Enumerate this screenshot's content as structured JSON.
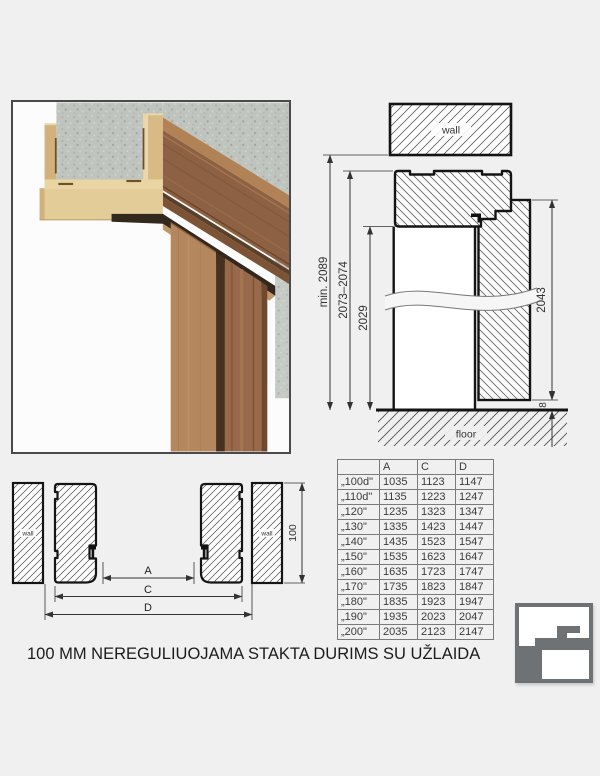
{
  "caption": "100 MM NEREGULIUOJAMA STAKTA DURIMS SU UŽLAIDA",
  "vertical_section": {
    "wall_label": "wall",
    "floor_label": "floor",
    "dims": {
      "min_total_height": "min. 2089",
      "frame_outer_height": "2073–2074",
      "opening_height": "2029",
      "door_leaf_height": "2043",
      "floor_gap": "8"
    }
  },
  "horizontal_section": {
    "wall_left_label": "wall",
    "wall_right_label": "wall",
    "dims": {
      "a": "A",
      "c": "C",
      "d": "D",
      "frame_depth": "100"
    }
  },
  "size_table": {
    "headers": [
      "",
      "A",
      "C",
      "D"
    ],
    "rows": [
      [
        "„100d\"",
        "1035",
        "1123",
        "1147"
      ],
      [
        "„110d\"",
        "1135",
        "1223",
        "1247"
      ],
      [
        "„120\"",
        "1235",
        "1323",
        "1347"
      ],
      [
        "„130\"",
        "1335",
        "1423",
        "1447"
      ],
      [
        "„140\"",
        "1435",
        "1523",
        "1547"
      ],
      [
        "„150\"",
        "1535",
        "1623",
        "1647"
      ],
      [
        "„160\"",
        "1635",
        "1723",
        "1747"
      ],
      [
        "„170\"",
        "1735",
        "1823",
        "1847"
      ],
      [
        "„180\"",
        "1835",
        "1923",
        "1947"
      ],
      [
        "„190\"",
        "1935",
        "2023",
        "2047"
      ],
      [
        "„200\"",
        "2035",
        "2123",
        "2147"
      ]
    ]
  },
  "colors": {
    "background": "#f0f0f0",
    "line": "#1a1a1a",
    "hatch": "#4a4a4a",
    "logo_gray": "#6e7275",
    "wood": "#8d6143",
    "mdf": "#e4cc99",
    "concrete": "#c0c4bf"
  }
}
